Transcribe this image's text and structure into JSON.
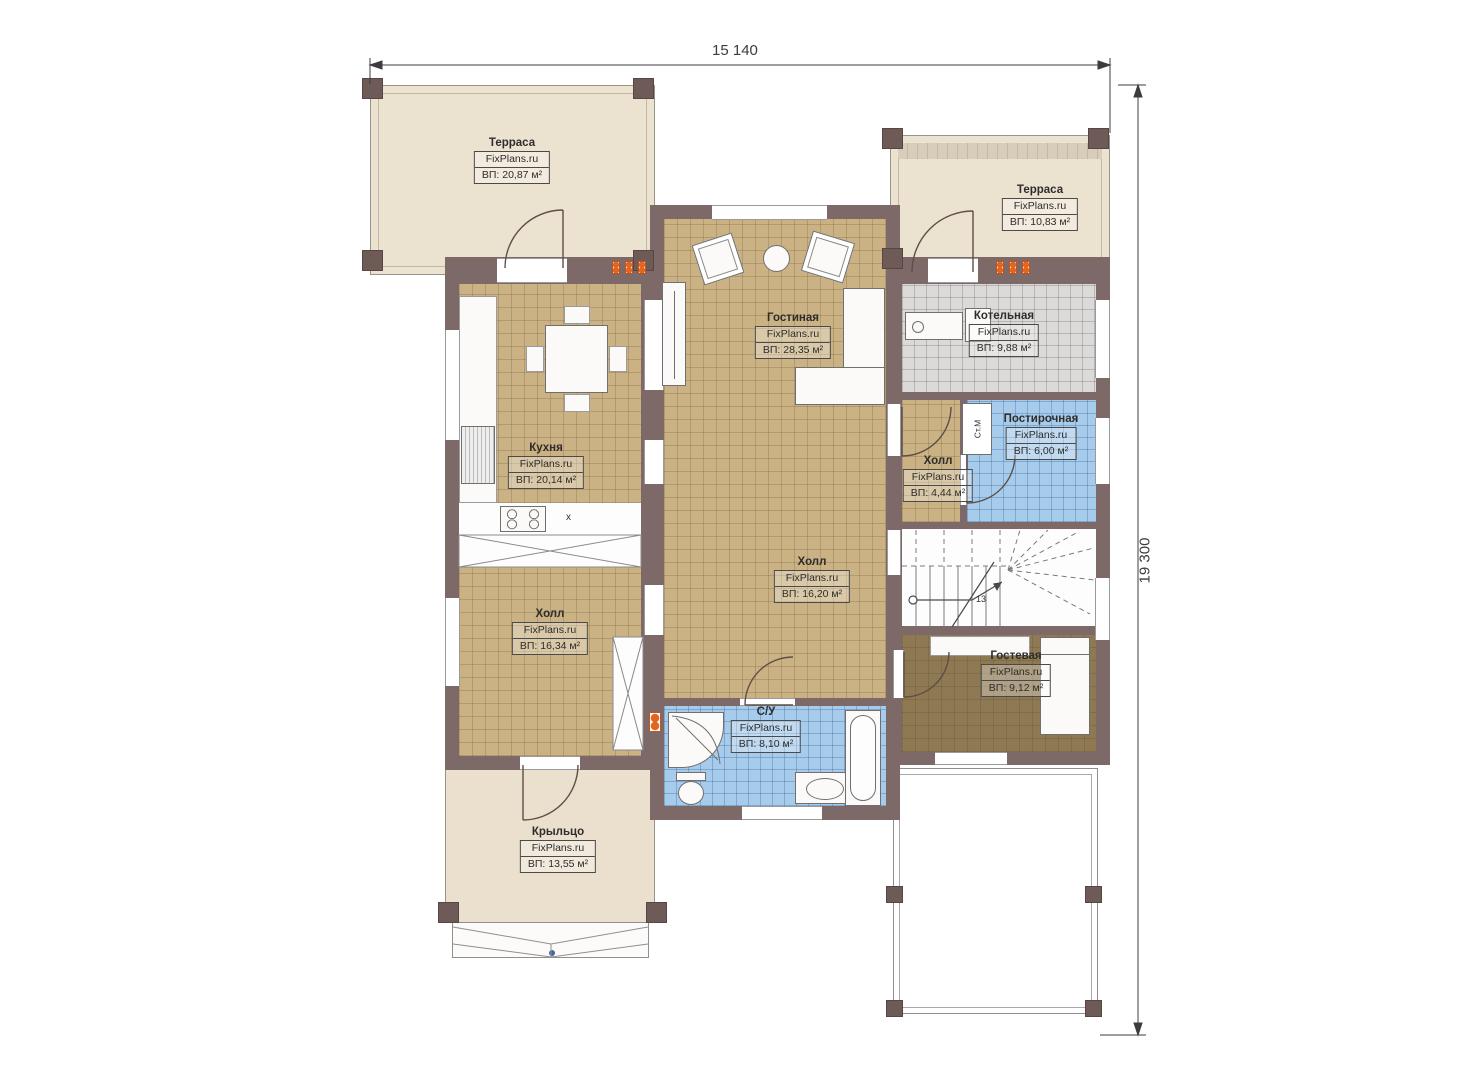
{
  "plan": {
    "source_brand": "FixPlans.ru",
    "floor_level": "1"
  },
  "dimensions": {
    "width_mm": "15 140",
    "height_mm": "19 300"
  },
  "rooms": [
    {
      "key": "terrace-left",
      "name": "Терраса",
      "brand": "FixPlans.ru",
      "area": "ВП: 20,87 м²"
    },
    {
      "key": "terrace-right",
      "name": "Терраса",
      "brand": "FixPlans.ru",
      "area": "ВП: 10,83 м²"
    },
    {
      "key": "living-room",
      "name": "Гостиная",
      "brand": "FixPlans.ru",
      "area": "ВП: 28,35 м²"
    },
    {
      "key": "boiler-room",
      "name": "Котельная",
      "brand": "FixPlans.ru",
      "area": "ВП: 9,88 м²"
    },
    {
      "key": "laundry",
      "name": "Постирочная",
      "brand": "FixPlans.ru",
      "area": "ВП: 6,00 м²"
    },
    {
      "key": "kitchen",
      "name": "Кухня",
      "brand": "FixPlans.ru",
      "area": "ВП: 20,14 м²"
    },
    {
      "key": "hall-small",
      "name": "Холл",
      "brand": "FixPlans.ru",
      "area": "ВП: 4,44 м²"
    },
    {
      "key": "hall-center",
      "name": "Холл",
      "brand": "FixPlans.ru",
      "area": "ВП: 16,20 м²"
    },
    {
      "key": "hall-left",
      "name": "Холл",
      "brand": "FixPlans.ru",
      "area": "ВП: 16,34 м²"
    },
    {
      "key": "guest-room",
      "name": "Гостевая",
      "brand": "FixPlans.ru",
      "area": "ВП: 9,12 м²"
    },
    {
      "key": "bathroom",
      "name": "С/У",
      "brand": "FixPlans.ru",
      "area": "ВП: 8,10 м²"
    },
    {
      "key": "porch",
      "name": "Крыльцо",
      "brand": "FixPlans.ru",
      "area": "ВП: 13,55 м²"
    }
  ],
  "annotations": {
    "washing_machine": "Ст.М",
    "stair_step_count": "13",
    "sink_marker": "х"
  },
  "colors": {
    "wall": "#7d6a68",
    "floor_tan": "#cbb284",
    "terrace_beige": "#ece2d0",
    "wet_blue": "#a7cbea",
    "boiler_gray": "#dbdad8",
    "guest_dark": "#8e7952",
    "accent_orange": "#e2661f"
  }
}
